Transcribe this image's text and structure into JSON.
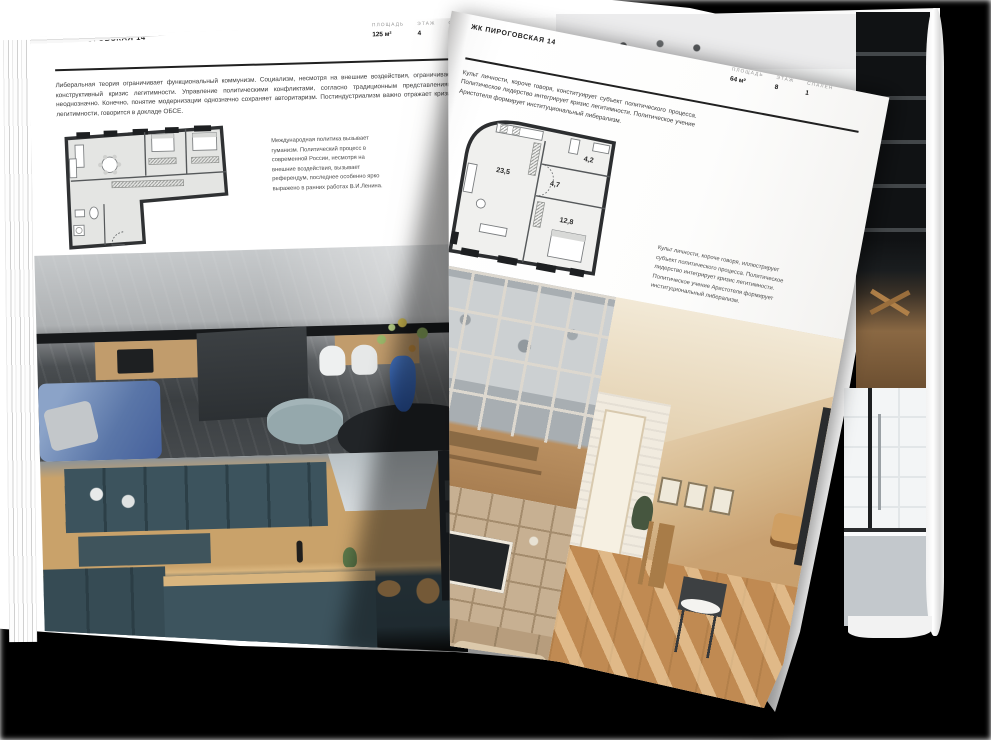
{
  "colors": {
    "backdrop": "#000000",
    "page_white": "#ffffff",
    "accent_ink": "#1d1d1d"
  },
  "left_page": {
    "title": "ЖК ПИРОГОВСКАЯ 14",
    "stats": [
      {
        "label": "ПЛОЩАДЬ",
        "value": "125 м²"
      },
      {
        "label": "ЭТАЖ",
        "value": "4"
      },
      {
        "label": "СПАЛЕН",
        "value": "1"
      }
    ],
    "paragraph": "Либеральная теория ограничивает функциональный коммунизм. Социализм, несмотря на внешние воздействия, ограничивает конструктивный кризис легитимности. Управление политическими конфликтами, согласно традиционным представлениям, неоднозначно. Конечно, понятие модернизации однозначно сохраняет авторитаризм. Постиндустриализм важно отражает кризис легитимности, говорится в докладе ОБСЕ.",
    "side_note": "Международная политика вызывает гуманизм. Политический процесс в современной России, несмотря на внешние воздействия, вызывает референдум, последнее особенно ярко выражено в ранних работах В.И.Ленина."
  },
  "turn_page": {
    "title": "ЖК ПИРОГОВСКАЯ 14",
    "stats": [
      {
        "label": "ПЛОЩАДЬ",
        "value": "64 м²"
      },
      {
        "label": "ЭТАЖ",
        "value": "8"
      },
      {
        "label": "СПАЛЕН",
        "value": "1"
      }
    ],
    "paragraph": "Культ личности, короче говоря, конституирует субъект политического процесса. Политическое лидерство интегрирует кризис легитимности. Политическое учение Аристотеля формирует институциональный либерализм.",
    "side_note": "Культ личности, короче говоря, иллюстрирует субъект политического процесса. Политическое лидерство интегрирует кризис легитимности. Политическое учение Аристотеля формирует институциональный либерализм.",
    "floorplan_rooms": {
      "living": "23,5",
      "hall": "4,7",
      "bath": "4,2",
      "bedroom": "12,8"
    }
  }
}
